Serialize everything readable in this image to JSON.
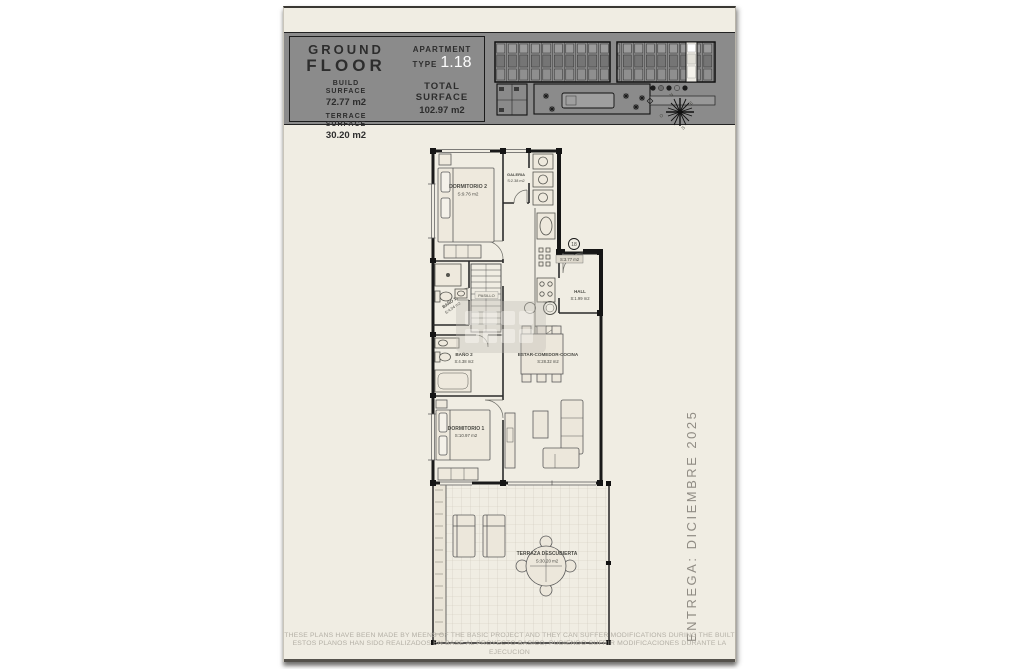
{
  "header": {
    "floor_line1": "GROUND",
    "floor_line2": "FLOOR",
    "build_label": "BUILD\nSURFACE",
    "build_value": "72.77 m2",
    "terrace_label": "TERRACE\nSURFACE",
    "terrace_value": "30.20 m2",
    "apartment_line1": "APARTMENT",
    "apartment_line2": "TYPE",
    "apartment_value": "1.18",
    "total_label": "TOTAL\nSURFACE",
    "total_value": "102.97 m2"
  },
  "compass": {
    "n": "N",
    "e": "E",
    "s": "S",
    "o": "O"
  },
  "plan": {
    "rooms": {
      "dormitorio2": {
        "name": "DORMITORIO 2",
        "area": "S:9.76 m2"
      },
      "galeria": {
        "name": "GALERIA",
        "area": "S:2.38 m2"
      },
      "hall": {
        "name": "HALL",
        "area": "S:1.99 m2"
      },
      "bano1": {
        "name": "BAÑO 1",
        "area": "S:4.04 m2"
      },
      "pasillo": {
        "name": "PASILLO"
      },
      "bano2": {
        "name": "BAÑO 2",
        "area": "S:4.38 m2"
      },
      "estar": {
        "name": "ESTAR-COMEDOR-COCINA",
        "area": "S:28.32 m2"
      },
      "dormitorio1": {
        "name": "DORMITORIO 1",
        "area": "S:10.97 m2"
      },
      "terraza": {
        "name": "TERRAZA DESCUBIERTA",
        "area": "S:30.20 m2"
      }
    },
    "entrance": {
      "unit_number": "18",
      "area": "S:3.77 m2"
    }
  },
  "side_note": "ENTREGA: DICIEMBRE 2025",
  "disclaimer": {
    "line1": "THESE PLANS HAVE BEEN MADE BY MEENS OF THE BASIC PROJECT AND THEY CAN SUFFER MODIFICATIONS DURING THE BUILT",
    "line2": "ESTOS PLANOS HAN SIDO REALIZADOS EN BASE AL PROYECTO BASICO, PUDIENDO SUFRIR MODIFICACIONES DURANTE LA EJECUCION"
  },
  "colors": {
    "page": "#f0ede3",
    "band": "#8b8b8b",
    "highlight_unit": "#efede6",
    "apartment_value_color": "#fdfdfd"
  }
}
